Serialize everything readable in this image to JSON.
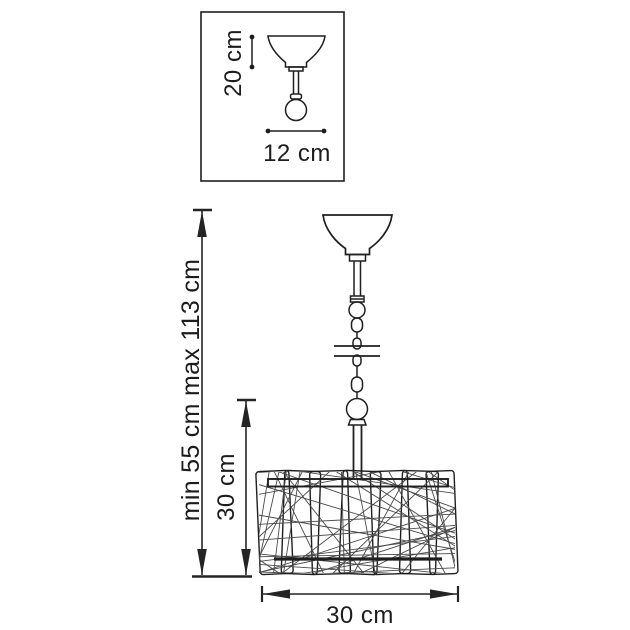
{
  "drawing": {
    "background": "#ffffff",
    "line_color": "#1f1f1f",
    "string_color": "#4a4a4a",
    "inset": {
      "height_label": "20 cm",
      "width_label": "12 cm"
    },
    "pendant": {
      "overall_height_label": "min 55 cm max 113 cm",
      "shade_height_label": "30 cm",
      "shade_width_label": "30 cm"
    }
  }
}
